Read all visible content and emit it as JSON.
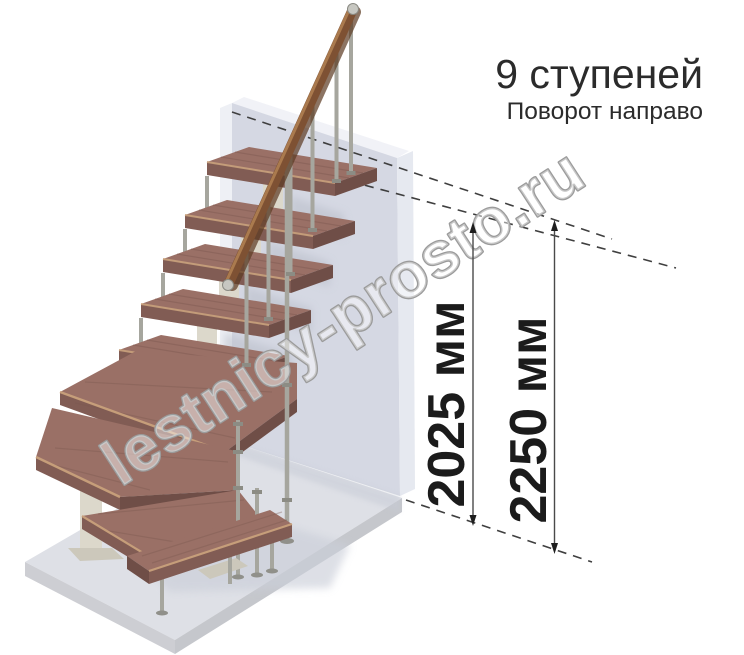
{
  "header": {
    "title": "9 ступеней",
    "subtitle": "Поворот направо"
  },
  "dimensions": {
    "to_top_step": {
      "label": "2025 мм"
    },
    "total_height": {
      "label": "2250 мм"
    }
  },
  "watermark": {
    "text": "lestnicy-prosto.ru"
  },
  "scene": {
    "steps_shown": "9",
    "turn_direction": "направо"
  },
  "colors": {
    "background": "#ffffff",
    "wood_top": "#9a7066",
    "wood_front": "#815c54",
    "wood_side": "#6f4e47",
    "wood_edge": "#c9a17c",
    "handrail": "#7e5133",
    "handrail_light": "#aa7a4e",
    "metal": "#a6a69e",
    "metal_dark": "#8c8c84",
    "spine": "#dcd8cb",
    "spine_shadow": "#b6b2a5",
    "wall": "#d5d8e3",
    "wall_side": "#e6e9f0",
    "wall_edge": "#eef0f5",
    "wall_top": "#f1f2f7",
    "floor": "#dee0e6",
    "floor_bevel_left": "#cdced3",
    "floor_bevel_right": "#c5c7cc",
    "shadow": "#c3c7d2",
    "dash_line": "#3f3f3f",
    "dim_text": "#1b1b1b",
    "title_text": "#2b2b2b",
    "watermark_outline": "#9b9b9b"
  }
}
